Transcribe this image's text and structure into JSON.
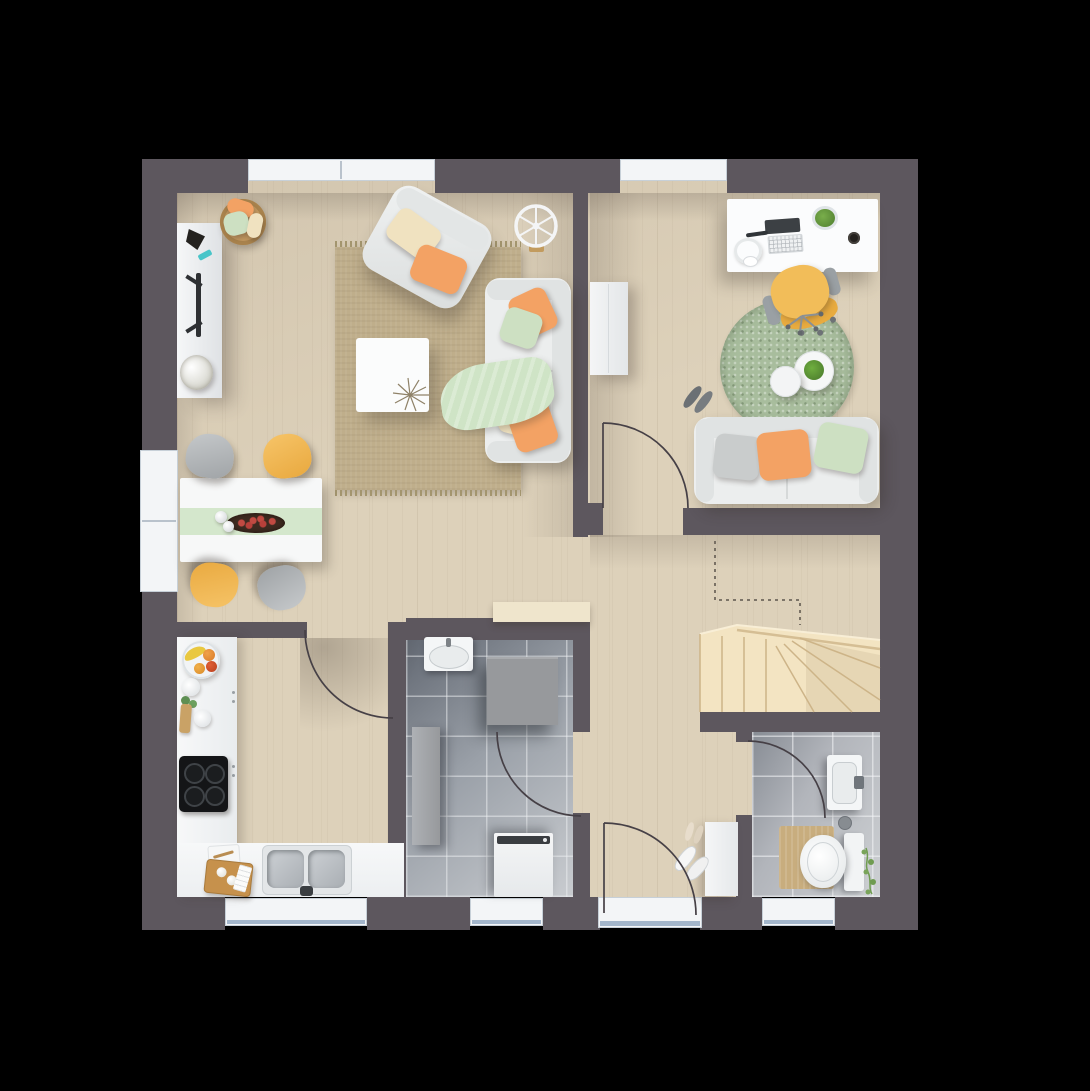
{
  "app": {
    "type": "architectural-floor-plan",
    "view": "top-down-2d-render",
    "background": "#000000"
  },
  "palette": {
    "wall": "#5d575e",
    "floor_wood": "#ddd1ba",
    "sill": "#f3f5f7",
    "glass": "#8fa6bf",
    "rug_living": "#bfae8b",
    "rug_fringe": "#a3956e",
    "stairs": "#f3e4c2",
    "stair_line": "#cdb488",
    "tile_dark": "#626872",
    "tile_mid": "#9aa0a8",
    "tile_light": "#c9ccd0",
    "white_furn": "#f2f3f4",
    "sofa": "#eceeee",
    "sofa_shade": "#e0e3e3",
    "orange": "#f3a264",
    "cream": "#f0e2c0",
    "green": "#cde0c2",
    "mint": "#cfe4c6",
    "gray_pillow": "#c9cccc",
    "yellow": "#f2bd59",
    "yellow_dark": "#e8ab3f",
    "sage": "#a8bd9d",
    "wood_item": "#c6914c",
    "basket": "#c1975f",
    "appliance_dark": "#141517",
    "metal": "#aeb3b8",
    "teal": "#49c5c9",
    "door_line": "#464046",
    "dashed": "#6f675c",
    "mat": "#c8ad7e",
    "plant": "#6f9c50"
  },
  "rooms": [
    {
      "id": "living-dining",
      "contents": [
        "tv-sideboard",
        "pillow-basket",
        "armchair",
        "area-rug",
        "coffee-table",
        "sofa",
        "throw-blanket",
        "dining-table",
        "dining-chairs",
        "decor-wheel-clock"
      ]
    },
    {
      "id": "office",
      "contents": [
        "desk",
        "laptop",
        "office-chair",
        "round-rug",
        "nesting-side-tables",
        "sofa",
        "wardrobe",
        "shoes"
      ]
    },
    {
      "id": "kitchen",
      "contents": [
        "l-shaped-counter",
        "fruit-plate",
        "jars",
        "induction-cooktop",
        "double-sink",
        "cutting-board",
        "tray"
      ]
    },
    {
      "id": "utility-room",
      "contents": [
        "wash-basin",
        "utility-unit",
        "tall-cabinet",
        "washing-machine"
      ]
    },
    {
      "id": "wc",
      "contents": [
        "wash-basin",
        "toilet",
        "bath-mat",
        "toilet-brush",
        "plant"
      ]
    },
    {
      "id": "hallway",
      "contents": [
        "bench",
        "shoe-cabinet",
        "shoes",
        "slippers"
      ]
    },
    {
      "id": "staircase",
      "contents": [
        "quarter-turn-winder-stairs",
        "ceiling-void-dashed-outline"
      ]
    }
  ],
  "doors": [
    {
      "id": "entrance-door",
      "location": "bottom-wall-hallway",
      "swing": "inward"
    },
    {
      "id": "office-door",
      "location": "office-south-wall",
      "swing": "into-office"
    },
    {
      "id": "kitchen-door",
      "location": "kitchen-north-wall",
      "swing": "into-kitchen"
    },
    {
      "id": "utility-door",
      "location": "utility-east-wall",
      "swing": "into-utility"
    },
    {
      "id": "wc-door",
      "location": "wc-west-wall",
      "swing": "into-wc"
    }
  ],
  "windows": [
    {
      "id": "window-top-left",
      "wall": "north"
    },
    {
      "id": "window-top-right",
      "wall": "north"
    },
    {
      "id": "window-left",
      "wall": "west"
    },
    {
      "id": "window-kitchen",
      "wall": "south"
    },
    {
      "id": "window-utility",
      "wall": "south"
    },
    {
      "id": "window-wc",
      "wall": "south"
    }
  ]
}
